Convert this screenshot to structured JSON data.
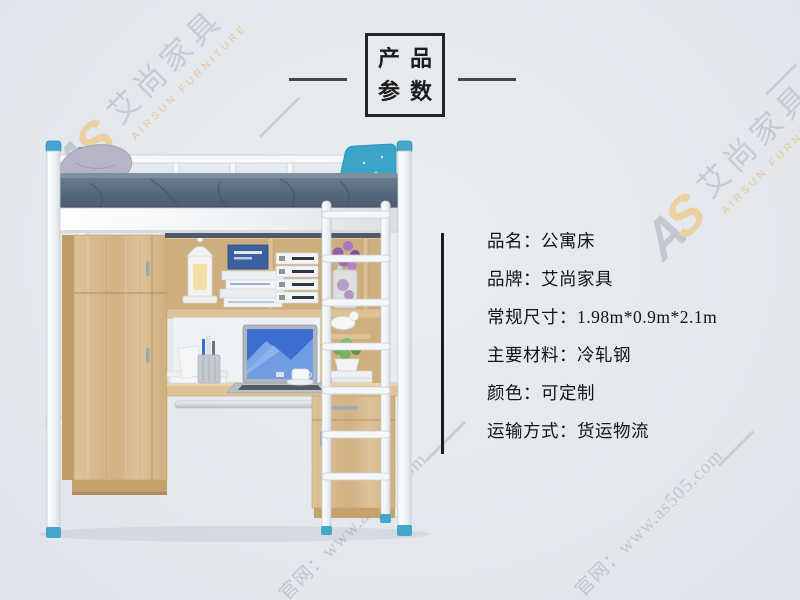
{
  "page": {
    "background": "#e4e8ed"
  },
  "title_box": {
    "line1": "产品",
    "line2": "参数"
  },
  "specs": [
    {
      "label": "品名：",
      "value": "公寓床"
    },
    {
      "label": "品牌：",
      "value": "艾尚家具"
    },
    {
      "label": "常规尺寸：",
      "value": "1.98m*0.9m*2.1m"
    },
    {
      "label": "主要材料：",
      "value": "冷轧钢"
    },
    {
      "label": "颜色：",
      "value": "可定制"
    },
    {
      "label": "运输方式：",
      "value": "货运物流"
    }
  ],
  "watermark": {
    "logo_a": "A",
    "logo_s": "S",
    "brand_cn": "艾尚家具",
    "brand_en": "AIRSUN FURNITURE",
    "site": "官网：www.as505.com",
    "gray": "#c6cbd1",
    "orange": "#e6c795"
  },
  "product_image": {
    "subject": "公寓床（上床下桌：钢架高架床+衣柜+书桌+梯子）",
    "colors": {
      "frame_white": "#f6f8fa",
      "wood": "#d8b98c",
      "mattress": "#566878",
      "accent_blue": "#42a7cb",
      "pillow_left": "#b7b4c6",
      "pillow_right": "#3aa5c8"
    }
  }
}
